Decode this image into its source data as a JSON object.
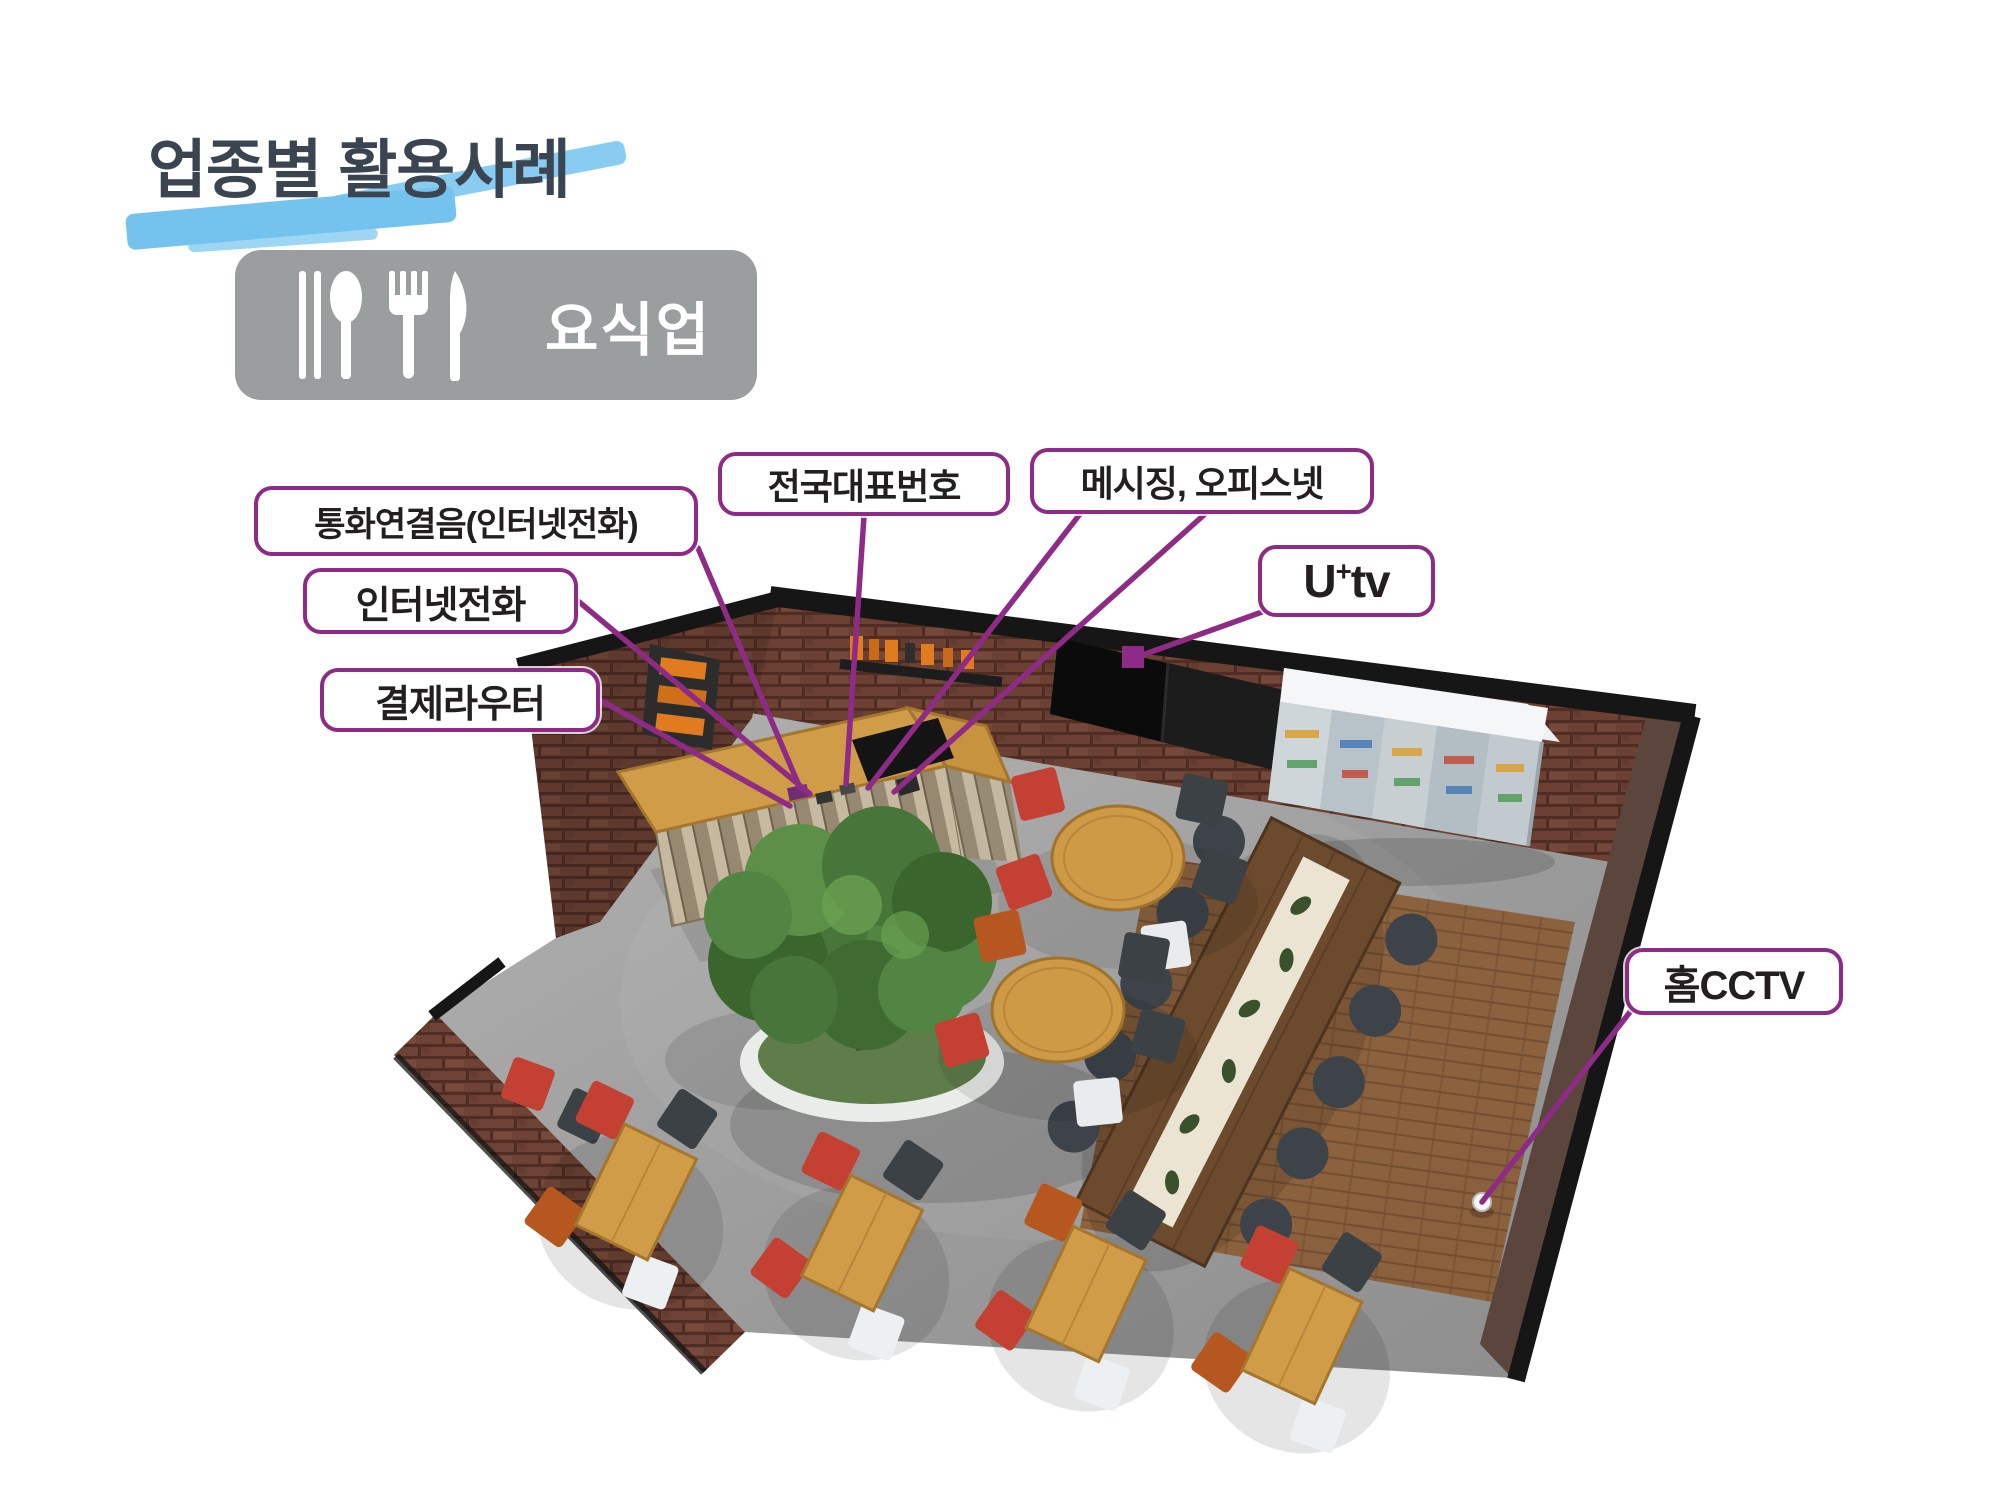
{
  "page": {
    "title": "업종별 활용사례"
  },
  "category_badge": {
    "label": "요식업",
    "icons": [
      "chopsticks-icon",
      "spoon-icon",
      "fork-icon",
      "knife-icon"
    ]
  },
  "callouts": {
    "ring_tone": {
      "label": "통화연결음(인터넷전화)"
    },
    "national_number": {
      "label": "전국대표번호"
    },
    "messaging": {
      "label": "메시징, 오피스넷"
    },
    "utv": {
      "prefix": "U",
      "sup": "+",
      "suffix": "tv"
    },
    "internet_phone": {
      "label": "인터넷전화"
    },
    "payment_router": {
      "label": "결제라우터"
    },
    "home_cctv": {
      "label": "홈CCTV"
    }
  },
  "colors": {
    "accent": "#8e2b86",
    "title_text": "#3b4552",
    "brush_highlight": "#74c3ee",
    "badge_background": "#9b9e9f",
    "badge_text": "#ffffff",
    "label_text": "#231f20"
  },
  "scene": {
    "objects": [
      "brick-walls",
      "entrance-opening",
      "reception-counter",
      "pos-terminal",
      "counter-devices",
      "wall-shelf-with-bottles",
      "wall-mounted-tv",
      "drink-display-case",
      "communal-table-with-stools",
      "round-table-with-chairs",
      "round-table-with-chairs",
      "indoor-tree-planter",
      "dining-table-set",
      "dining-table-set",
      "dining-table-set",
      "dining-table-set",
      "cctv-camera"
    ]
  }
}
